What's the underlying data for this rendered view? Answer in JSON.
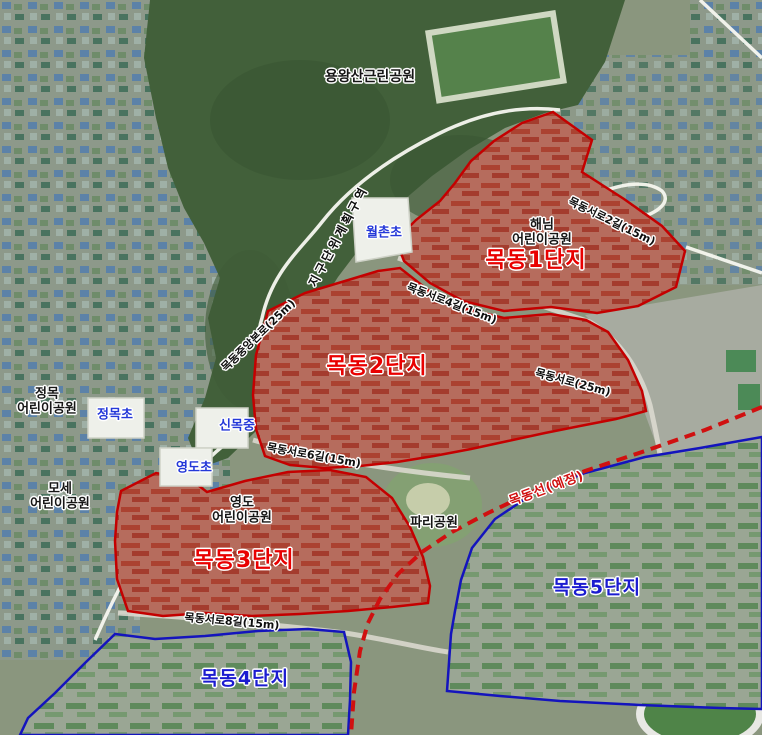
{
  "map": {
    "parks": {
      "yongwangsan": "용왕산근린공원",
      "haenim": [
        "해님",
        "어린이공원"
      ],
      "jeongmok": [
        "정목",
        "어린이공원"
      ],
      "mose": [
        "모세",
        "어린이공원"
      ],
      "yeongdo": [
        "영도",
        "어린이공원"
      ],
      "pari": "파리공원"
    },
    "schools": {
      "wolchon": "월촌초",
      "sinmok": "신목중",
      "jeongmokcho": "정목초",
      "yeongdocho": "영도초"
    },
    "complexes": {
      "c1": "목동1단지",
      "c2": "목동2단지",
      "c3": "목동3단지",
      "c4": "목동4단지",
      "c5": "목동5단지"
    },
    "roads": {
      "seoro2": "목동서로2길(15m)",
      "seoro4": "목동서로4길(15m)",
      "seoro6": "목동서로6길(15m)",
      "seoro8": "목동서로8길(15m)",
      "seoro": "목동서로(25m)",
      "jungangbon": "목동중앙본로(25m)",
      "district_zone": "지구단위계획구역",
      "rail_planned": "목동선(예정)"
    },
    "colors": {
      "complex_red_text": "#e90000",
      "complex_blue_text": "#1b1bd0",
      "school_text": "#2438d8",
      "park_text": "#161616",
      "region_red_stroke": "#c40000",
      "region_blue_stroke": "#1414bd",
      "rail_red": "#d01010"
    }
  }
}
